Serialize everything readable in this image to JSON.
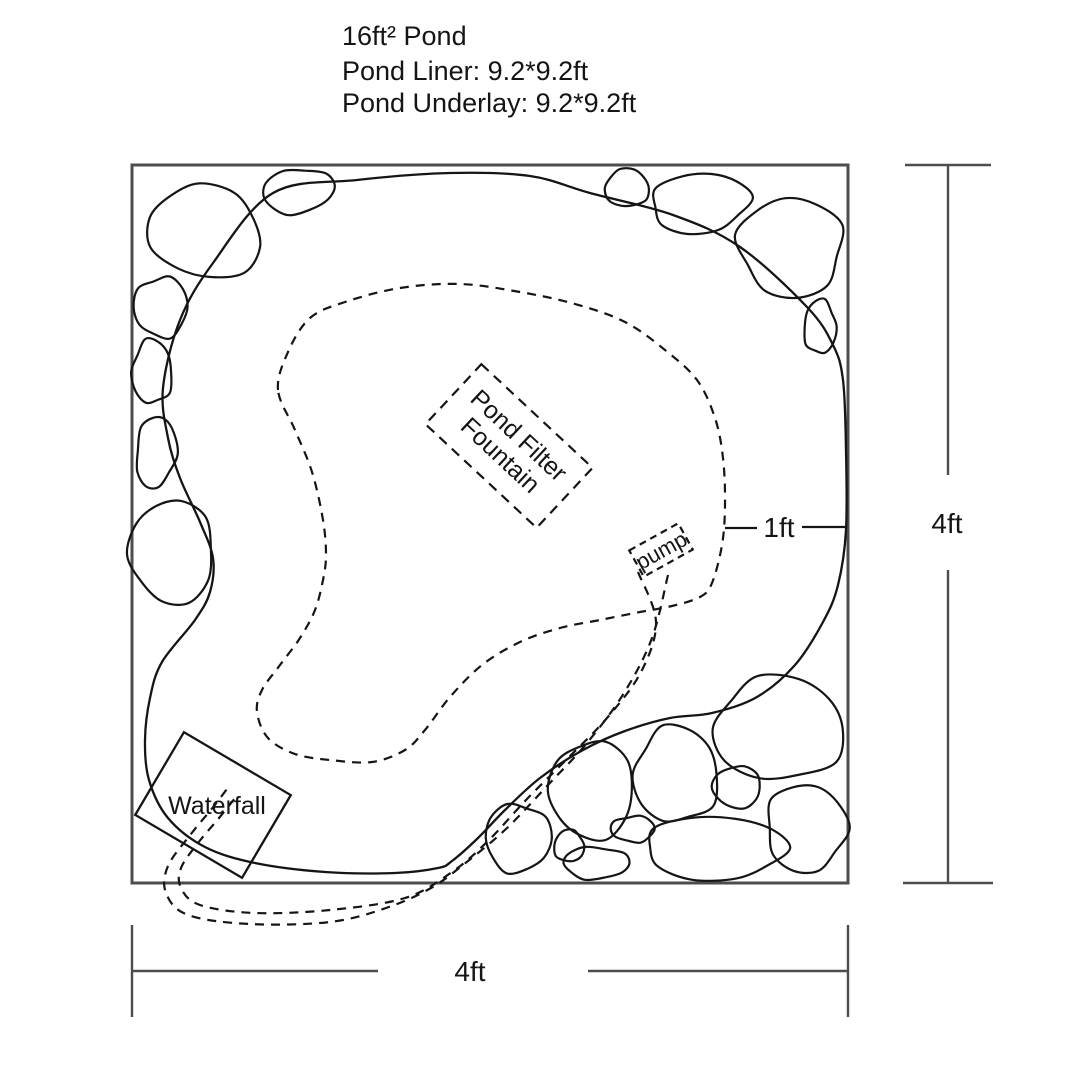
{
  "title": {
    "line1": "16ft² Pond",
    "line2": "Pond Liner: 9.2*9.2ft",
    "line3": "Pond Underlay: 9.2*9.2ft"
  },
  "labels": {
    "filter_line1": "Pond Filter",
    "filter_line2": "Fountain",
    "pump": "pump",
    "waterfall": "Waterfall",
    "edge_gap": "1ft",
    "width_dim": "4ft",
    "height_dim": "4ft"
  },
  "colors": {
    "ink": "#151515",
    "frame": "#4d4d4d",
    "background": "#ffffff"
  },
  "diagram": {
    "frame": {
      "x": 132,
      "y": 165,
      "w": 716,
      "h": 718
    },
    "pond_outline": [
      [
        163,
        388
      ],
      [
        168,
        438
      ],
      [
        180,
        478
      ],
      [
        200,
        522
      ],
      [
        213,
        558
      ],
      [
        210,
        592
      ],
      [
        195,
        620
      ],
      [
        162,
        662
      ],
      [
        150,
        698
      ],
      [
        145,
        740
      ],
      [
        149,
        780
      ],
      [
        168,
        818
      ],
      [
        205,
        847
      ],
      [
        255,
        863
      ],
      [
        325,
        872
      ],
      [
        395,
        873
      ],
      [
        438,
        868
      ],
      [
        452,
        861
      ],
      [
        478,
        838
      ],
      [
        505,
        810
      ],
      [
        540,
        778
      ],
      [
        583,
        750
      ],
      [
        625,
        731
      ],
      [
        670,
        718
      ],
      [
        712,
        713
      ],
      [
        757,
        697
      ],
      [
        795,
        665
      ],
      [
        823,
        622
      ],
      [
        838,
        585
      ],
      [
        846,
        530
      ],
      [
        846,
        450
      ],
      [
        843,
        380
      ],
      [
        833,
        345
      ],
      [
        807,
        307
      ],
      [
        740,
        247
      ],
      [
        673,
        215
      ],
      [
        590,
        193
      ],
      [
        530,
        176
      ],
      [
        450,
        173
      ],
      [
        357,
        180
      ],
      [
        273,
        193
      ],
      [
        213,
        263
      ],
      [
        180,
        320
      ]
    ],
    "shelf_outline": [
      [
        278,
        390
      ],
      [
        288,
        352
      ],
      [
        310,
        318
      ],
      [
        345,
        302
      ],
      [
        400,
        288
      ],
      [
        460,
        284
      ],
      [
        520,
        292
      ],
      [
        575,
        304
      ],
      [
        625,
        322
      ],
      [
        665,
        350
      ],
      [
        697,
        380
      ],
      [
        715,
        418
      ],
      [
        723,
        458
      ],
      [
        725,
        505
      ],
      [
        722,
        545
      ],
      [
        712,
        583
      ],
      [
        700,
        597
      ],
      [
        672,
        606
      ],
      [
        640,
        612
      ],
      [
        600,
        620
      ],
      [
        560,
        628
      ],
      [
        520,
        642
      ],
      [
        482,
        665
      ],
      [
        450,
        697
      ],
      [
        425,
        730
      ],
      [
        405,
        750
      ],
      [
        372,
        762
      ],
      [
        330,
        760
      ],
      [
        295,
        754
      ],
      [
        268,
        738
      ],
      [
        257,
        712
      ],
      [
        262,
        690
      ],
      [
        280,
        665
      ],
      [
        300,
        638
      ],
      [
        315,
        610
      ],
      [
        323,
        580
      ],
      [
        326,
        555
      ],
      [
        323,
        520
      ],
      [
        312,
        472
      ],
      [
        295,
        430
      ]
    ],
    "tube_a": [
      [
        638,
        572
      ],
      [
        656,
        622
      ],
      [
        641,
        672
      ],
      [
        607,
        718
      ],
      [
        566,
        760
      ],
      [
        526,
        800
      ],
      [
        488,
        841
      ],
      [
        452,
        872
      ],
      [
        405,
        898
      ],
      [
        330,
        910
      ],
      [
        255,
        913
      ],
      [
        200,
        905
      ],
      [
        181,
        888
      ],
      [
        181,
        868
      ],
      [
        198,
        843
      ],
      [
        219,
        818
      ],
      [
        236,
        797
      ]
    ],
    "tube_b": [
      [
        668,
        575
      ],
      [
        652,
        638
      ],
      [
        624,
        693
      ],
      [
        587,
        743
      ],
      [
        547,
        786
      ],
      [
        507,
        828
      ],
      [
        468,
        861
      ],
      [
        431,
        888
      ],
      [
        386,
        908
      ],
      [
        330,
        922
      ],
      [
        250,
        924
      ],
      [
        188,
        915
      ],
      [
        166,
        893
      ],
      [
        168,
        866
      ],
      [
        191,
        834
      ],
      [
        214,
        806
      ],
      [
        230,
        785
      ]
    ],
    "rocks": [
      [
        205,
        232,
        57,
        46,
        15
      ],
      [
        298,
        191,
        36,
        22,
        -8
      ],
      [
        161,
        307,
        27,
        30,
        0
      ],
      [
        152,
        372,
        20,
        32,
        0
      ],
      [
        156,
        452,
        20,
        36,
        6
      ],
      [
        172,
        552,
        42,
        52,
        -4
      ],
      [
        627,
        188,
        22,
        19,
        0
      ],
      [
        700,
        203,
        49,
        30,
        -6
      ],
      [
        791,
        247,
        52,
        50,
        12
      ],
      [
        820,
        327,
        16,
        27,
        0
      ],
      [
        518,
        838,
        33,
        34,
        0
      ],
      [
        592,
        790,
        42,
        49,
        0
      ],
      [
        569,
        846,
        15,
        16,
        0
      ],
      [
        596,
        863,
        33,
        16,
        0
      ],
      [
        633,
        829,
        22,
        13,
        0
      ],
      [
        676,
        775,
        42,
        48,
        0
      ],
      [
        715,
        848,
        70,
        32,
        0
      ],
      [
        737,
        787,
        24,
        21,
        0
      ],
      [
        779,
        729,
        65,
        52,
        0
      ],
      [
        806,
        828,
        40,
        44,
        0
      ]
    ]
  }
}
